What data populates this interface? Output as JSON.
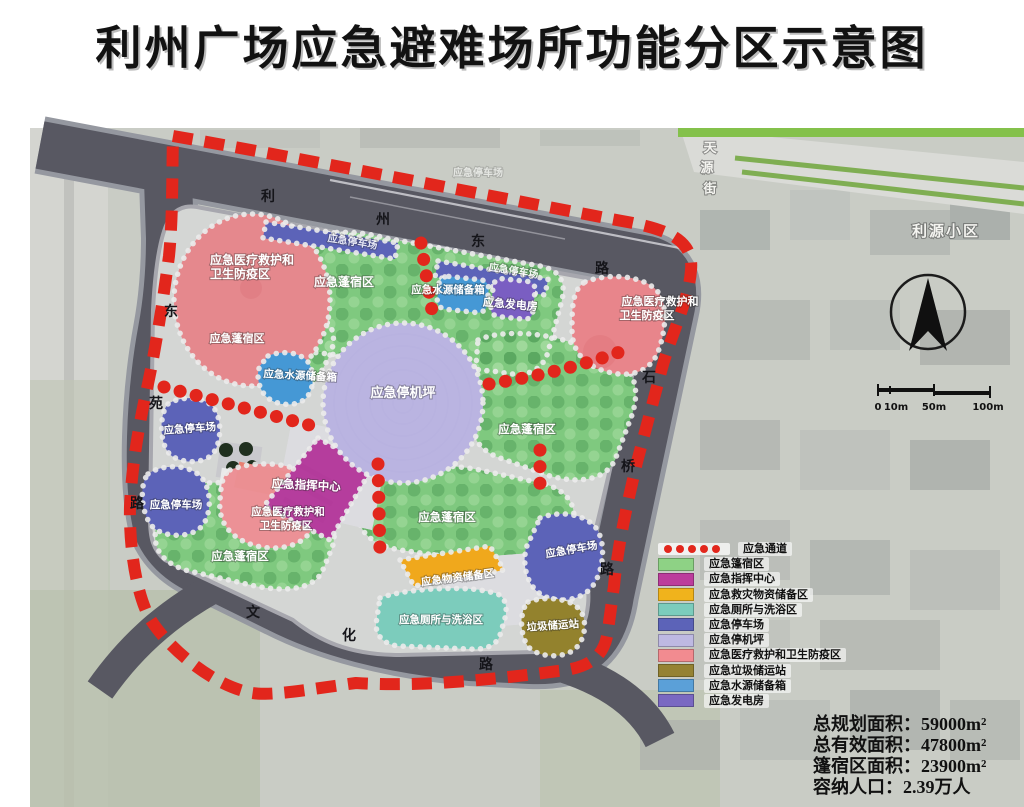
{
  "title": "利州广场应急避难场所功能分区示意图",
  "map": {
    "roads": {
      "top": [
        "利",
        "州",
        "东",
        "路"
      ],
      "left": [
        "东",
        "苑",
        "路"
      ],
      "right": [
        "石",
        "桥",
        "路"
      ],
      "bottom": [
        "文",
        "化",
        "路"
      ]
    },
    "streets": {
      "yuanjie": [
        "天",
        "源",
        "街"
      ],
      "liyuan_area": "利源小区"
    },
    "zones": {
      "tent": "应急蓬宿区",
      "helipad": "应急停机坪",
      "command": "应急指挥中心",
      "supplies": "应急物资储备区",
      "toilet": "应急厕所与洗浴区",
      "parking": "应急停车场",
      "medical1": "应急医疗救护和",
      "medical2": "卫生防疫区",
      "garbage": "垃圾储运站",
      "water": "应急水源储备箱",
      "generator": "应急发电房"
    }
  },
  "legend": {
    "items": [
      {
        "label": "应急通道",
        "color": "#e2261c",
        "type": "dots"
      },
      {
        "label": "应急篷宿区",
        "color": "#8ed285"
      },
      {
        "label": "应急指挥中心",
        "color": "#bc3d9c"
      },
      {
        "label": "应急救灾物资储备区",
        "color": "#f0b31c"
      },
      {
        "label": "应急厕所与洗浴区",
        "color": "#7cccbc"
      },
      {
        "label": "应急停车场",
        "color": "#5c63b8"
      },
      {
        "label": "应急停机坪",
        "color": "#beb9e2"
      },
      {
        "label": "应急医疗救护和卫生防疫区",
        "color": "#f28b90"
      },
      {
        "label": "应急垃圾储运站",
        "color": "#958233"
      },
      {
        "label": "应急水源储备箱",
        "color": "#5ba0d8"
      },
      {
        "label": "应急发电房",
        "color": "#7a68c2"
      }
    ]
  },
  "scale": {
    "ticks": [
      "0",
      "10m",
      "50m",
      "100m"
    ]
  },
  "stats": {
    "lines": [
      "总规划面积：59000m²",
      "总有效面积：47800m²",
      "篷宿区面积：23900m²",
      "容纳人口：2.39万人"
    ]
  }
}
